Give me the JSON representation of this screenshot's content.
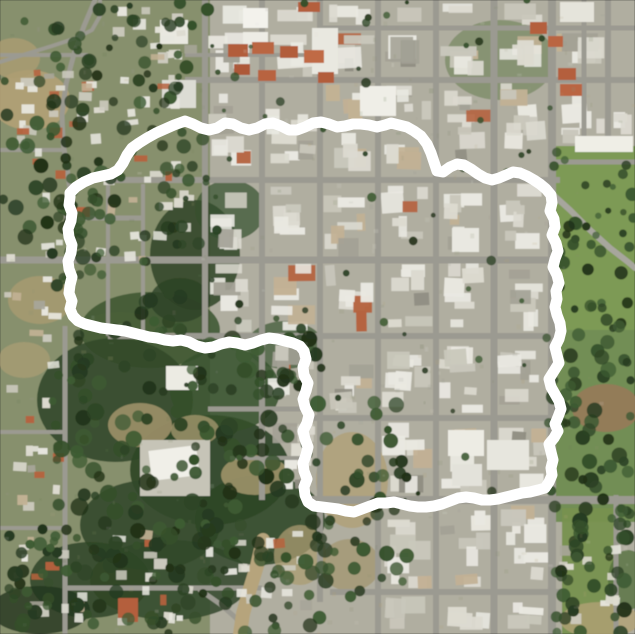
{
  "map": {
    "kind": "satellite-aerial-photo",
    "width": 635,
    "height": 634,
    "seed": 1337,
    "base_color": "#b0aea0",
    "road_color": "#9b9a91",
    "boundary": {
      "stroke": "#ffffff",
      "stroke_width": 11,
      "points": [
        70,
        193,
        76,
        187,
        84,
        182,
        93,
        178,
        102,
        176,
        111,
        174,
        118,
        170,
        123,
        163,
        127,
        155,
        132,
        148,
        139,
        143,
        147,
        138,
        156,
        133,
        165,
        129,
        174,
        125,
        185,
        121,
        193,
        124,
        201,
        128,
        209,
        130,
        217,
        128,
        225,
        123,
        233,
        124,
        241,
        128,
        249,
        130,
        257,
        128,
        265,
        124,
        273,
        123,
        281,
        126,
        289,
        130,
        297,
        130,
        305,
        127,
        313,
        123,
        321,
        122,
        329,
        124,
        337,
        127,
        345,
        126,
        353,
        124,
        361,
        124,
        369,
        125,
        377,
        127,
        385,
        125,
        391,
        123,
        399,
        125,
        407,
        127,
        414,
        131,
        421,
        136,
        427,
        144,
        431,
        153,
        434,
        162,
        437,
        171,
        443,
        172,
        450,
        167,
        457,
        164,
        464,
        165,
        471,
        169,
        478,
        174,
        485,
        178,
        492,
        180,
        499,
        178,
        506,
        175,
        513,
        172,
        520,
        173,
        527,
        176,
        534,
        180,
        540,
        184,
        546,
        189,
        551,
        195,
        552,
        203,
        550,
        211,
        554,
        219,
        555,
        227,
        552,
        235,
        556,
        243,
        558,
        251,
        555,
        259,
        553,
        267,
        557,
        275,
        559,
        283,
        556,
        291,
        557,
        299,
        555,
        307,
        557,
        315,
        560,
        323,
        561,
        331,
        559,
        339,
        555,
        347,
        557,
        355,
        559,
        363,
        554,
        371,
        549,
        379,
        551,
        387,
        555,
        394,
        559,
        401,
        561,
        409,
        558,
        417,
        555,
        424,
        558,
        431,
        554,
        438,
        549,
        444,
        551,
        452,
        553,
        460,
        551,
        468,
        552,
        475,
        549,
        482,
        545,
        488,
        538,
        490,
        530,
        492,
        522,
        493,
        514,
        495,
        506,
        497,
        498,
        499,
        490,
        500,
        482,
        500,
        474,
        498,
        466,
        497,
        458,
        498,
        450,
        501,
        442,
        504,
        434,
        506,
        426,
        507,
        418,
        507,
        410,
        506,
        402,
        504,
        394,
        502,
        386,
        503,
        378,
        503,
        370,
        506,
        362,
        509,
        354,
        512,
        346,
        511,
        338,
        509,
        330,
        508,
        322,
        507,
        314,
        506,
        308,
        502,
        305,
        495,
        304,
        487,
        307,
        479,
        304,
        471,
        303,
        463,
        306,
        455,
        308,
        447,
        305,
        439,
        303,
        431,
        307,
        423,
        309,
        415,
        305,
        407,
        303,
        399,
        306,
        391,
        308,
        383,
        304,
        375,
        303,
        367,
        306,
        359,
        304,
        351,
        300,
        346,
        293,
        343,
        285,
        341,
        277,
        339,
        269,
        338,
        261,
        340,
        253,
        343,
        245,
        345,
        237,
        343,
        229,
        342,
        221,
        344,
        213,
        347,
        205,
        348,
        197,
        346,
        189,
        342,
        181,
        340,
        173,
        341,
        165,
        340,
        157,
        338,
        149,
        337,
        141,
        335,
        133,
        333,
        125,
        331,
        117,
        330,
        109,
        329,
        101,
        328,
        93,
        326,
        85,
        324,
        78,
        321,
        73,
        316,
        70,
        309,
        72,
        301,
        69,
        293,
        70,
        285,
        72,
        277,
        69,
        269,
        68,
        261,
        71,
        253,
        72,
        245,
        69,
        237,
        68,
        229,
        71,
        221,
        72,
        213,
        69,
        205,
        70,
        197
      ]
    },
    "terrain_patches": [
      [
        "r",
        0,
        0,
        210,
        634,
        "#87906d",
        1
      ],
      [
        "e",
        30,
        100,
        40,
        30,
        "#b2a176",
        0.9
      ],
      [
        "e",
        14,
        58,
        26,
        20,
        "#ab9c72",
        0.8
      ],
      [
        "e",
        40,
        300,
        32,
        24,
        "#ab9c72",
        0.75
      ],
      [
        "e",
        24,
        360,
        26,
        18,
        "#b2a176",
        0.6
      ],
      [
        "e",
        120,
        330,
        40,
        18,
        "#a3946c",
        0.5
      ],
      [
        "e",
        150,
        330,
        70,
        38,
        "#3b5530",
        0.85
      ],
      [
        "e",
        195,
        255,
        45,
        55,
        "#2f4527",
        0.85
      ],
      [
        "e",
        230,
        210,
        35,
        30,
        "#35502c",
        0.7
      ],
      [
        "e",
        115,
        400,
        78,
        62,
        "#32492a",
        0.9
      ],
      [
        "e",
        210,
        470,
        80,
        55,
        "#2e4527",
        0.92
      ],
      [
        "e",
        150,
        525,
        70,
        45,
        "#32492a",
        0.9
      ],
      [
        "e",
        260,
        520,
        65,
        45,
        "#2e4527",
        0.88
      ],
      [
        "e",
        225,
        390,
        55,
        42,
        "#35502c",
        0.85
      ],
      [
        "e",
        180,
        300,
        30,
        22,
        "#2c4126",
        0.8
      ],
      [
        "e",
        285,
        345,
        38,
        24,
        "#3b5530",
        0.7
      ],
      [
        "e",
        170,
        580,
        80,
        40,
        "#31482a",
        0.85
      ],
      [
        "e",
        90,
        580,
        60,
        38,
        "#2e4527",
        0.85
      ],
      [
        "e",
        40,
        610,
        50,
        24,
        "#24351f",
        0.8
      ],
      [
        "e",
        140,
        425,
        32,
        22,
        "#a3946c",
        0.85
      ],
      [
        "e",
        255,
        475,
        34,
        20,
        "#ab9c72",
        0.8
      ],
      [
        "e",
        195,
        430,
        24,
        15,
        "#b2a176",
        0.7
      ],
      [
        "e",
        300,
        555,
        26,
        30,
        "#ab9c72",
        0.75
      ],
      [
        "e",
        352,
        480,
        36,
        48,
        "#b0a077",
        0.8
      ],
      [
        "e",
        350,
        565,
        30,
        26,
        "#a3946c",
        0.7
      ],
      [
        "r",
        556,
        146,
        79,
        184,
        "#7d9a55",
        1
      ],
      [
        "r",
        548,
        330,
        87,
        192,
        "#6f8c50",
        0.95
      ],
      [
        "e",
        606,
        408,
        34,
        24,
        "#97795a",
        0.9
      ],
      [
        "r",
        562,
        508,
        52,
        126,
        "#77914f",
        0.95
      ],
      [
        "e",
        600,
        620,
        40,
        18,
        "#b2a176",
        0.8
      ],
      [
        "e",
        628,
        580,
        20,
        30,
        "#55703f",
        0.8
      ],
      [
        "e",
        500,
        60,
        55,
        40,
        "#5d7746",
        0.5
      ]
    ],
    "grid": {
      "xs": [
        205,
        262,
        320,
        378,
        436,
        494,
        552,
        608,
        635
      ],
      "ys": [
        0,
        28,
        80,
        180,
        260,
        336,
        418,
        500,
        592,
        634
      ]
    },
    "roads": {
      "v": [
        [
          205,
          0,
          350,
          6
        ],
        [
          262,
          0,
          500,
          6
        ],
        [
          320,
          0,
          602,
          6
        ],
        [
          378,
          0,
          634,
          6
        ],
        [
          436,
          0,
          634,
          6
        ],
        [
          494,
          0,
          634,
          7
        ],
        [
          552,
          0,
          634,
          8
        ],
        [
          608,
          0,
          152,
          6
        ],
        [
          584,
          0,
          150,
          5
        ],
        [
          616,
          495,
          634,
          5
        ],
        [
          108,
          180,
          336,
          4
        ],
        [
          143,
          184,
          336,
          4
        ],
        [
          65,
          326,
          634,
          5
        ]
      ],
      "h": [
        [
          28,
          320,
          635,
          5
        ],
        [
          55,
          185,
          322,
          4
        ],
        [
          55,
          0,
          88,
          4
        ],
        [
          80,
          185,
          635,
          6
        ],
        [
          150,
          0,
          64,
          4
        ],
        [
          162,
          548,
          635,
          5
        ],
        [
          180,
          108,
          560,
          6
        ],
        [
          218,
          64,
          145,
          5
        ],
        [
          260,
          0,
          560,
          7
        ],
        [
          336,
          108,
          560,
          6
        ],
        [
          409,
          208,
          308,
          5
        ],
        [
          418,
          312,
          560,
          6
        ],
        [
          458,
          230,
          308,
          4
        ],
        [
          432,
          0,
          64,
          4
        ],
        [
          500,
          306,
          635,
          8
        ],
        [
          528,
          0,
          64,
          4
        ],
        [
          588,
          64,
          262,
          5
        ],
        [
          592,
          330,
          560,
          6
        ]
      ],
      "paths": [
        {
          "pts": [
            95,
            0,
            84,
            26,
            74,
            54,
            66,
            84,
            62,
            114,
            63,
            142,
            67,
            168,
            70,
            190
          ],
          "w": 5
        },
        {
          "pts": [
            0,
            62,
            26,
            54,
            52,
            46,
            76,
            38,
            92,
            30,
            100,
            16,
            100,
            0
          ],
          "w": 4
        },
        {
          "pts": [
            550,
            192,
            570,
            210,
            590,
            230,
            610,
            248,
            628,
            262,
            635,
            268
          ],
          "w": 6,
          "c": "#a7a69d"
        },
        {
          "pts": [
            200,
            590,
            220,
            604,
            236,
            618,
            246,
            634
          ],
          "w": 5
        },
        {
          "pts": [
            263,
            540,
            257,
            566,
            249,
            592,
            243,
            614,
            240,
            634
          ],
          "w": 14,
          "c": "#b6a47c"
        }
      ]
    },
    "landmarks": [
      [
        140,
        440,
        70,
        56,
        "#c6c4b7",
        0
      ],
      [
        150,
        448,
        48,
        30,
        "#f0efe8",
        -7
      ],
      [
        166,
        366,
        32,
        24,
        "#ecebe3",
        0
      ],
      [
        160,
        20,
        28,
        24,
        "#e9e8e0",
        0
      ],
      [
        162,
        80,
        34,
        28,
        "#dcdcd4",
        0
      ],
      [
        243,
        8,
        25,
        20,
        "#f3f2ec",
        0
      ],
      [
        243,
        32,
        25,
        17,
        "#edece5",
        0
      ],
      [
        312,
        28,
        26,
        46,
        "#e9e8e0",
        0
      ],
      [
        360,
        86,
        36,
        30,
        "#efeee7",
        0
      ],
      [
        560,
        2,
        34,
        20,
        "#e5e4db",
        0
      ],
      [
        575,
        136,
        58,
        16,
        "#efeee6",
        0
      ],
      [
        452,
        228,
        27,
        24,
        "#e9e8e1",
        0
      ],
      [
        448,
        430,
        36,
        26,
        "#edece4",
        0
      ],
      [
        487,
        440,
        42,
        30,
        "#e7e6de",
        0
      ],
      [
        452,
        464,
        30,
        22,
        "#e3e2da",
        0
      ],
      [
        228,
        44,
        20,
        13,
        "#b25d3b",
        0
      ],
      [
        252,
        42,
        22,
        12,
        "#ba6642",
        0
      ],
      [
        280,
        46,
        18,
        12,
        "#b25d3b",
        0
      ],
      [
        304,
        50,
        20,
        13,
        "#c06a45",
        0
      ],
      [
        318,
        72,
        16,
        11,
        "#b25d3b",
        0
      ],
      [
        234,
        64,
        16,
        11,
        "#ad5838",
        0
      ],
      [
        258,
        70,
        18,
        11,
        "#b86340",
        0
      ],
      [
        530,
        22,
        17,
        12,
        "#b45f3d",
        0
      ],
      [
        548,
        36,
        15,
        11,
        "#ba6542",
        0
      ],
      [
        558,
        68,
        18,
        12,
        "#b45f3d",
        0
      ],
      [
        560,
        84,
        22,
        12,
        "#ba6542",
        0
      ],
      [
        298,
        2,
        22,
        10,
        "#b45f3d",
        0
      ],
      [
        118,
        598,
        20,
        24,
        "#b45f3d",
        0
      ]
    ],
    "house_regions": [
      {
        "x": 4,
        "y": 66,
        "w": 196,
        "h": 196,
        "count": 60
      },
      {
        "x": 2,
        "y": 268,
        "w": 62,
        "h": 255,
        "count": 22
      },
      {
        "x": 6,
        "y": 526,
        "w": 310,
        "h": 102,
        "count": 42
      },
      {
        "x": 100,
        "y": 2,
        "w": 100,
        "h": 62,
        "count": 16
      },
      {
        "x": 558,
        "y": 532,
        "w": 70,
        "h": 96,
        "count": 10
      }
    ],
    "tree_regions": [
      {
        "x": 52,
        "y": 326,
        "w": 266,
        "h": 250,
        "count": 150,
        "rmin": 4,
        "rmax": 9
      },
      {
        "x": 56,
        "y": 118,
        "w": 150,
        "h": 212,
        "count": 65,
        "rmin": 4,
        "rmax": 8
      },
      {
        "x": 0,
        "y": 0,
        "w": 96,
        "h": 264,
        "count": 48,
        "rmin": 4,
        "rmax": 8
      },
      {
        "x": 96,
        "y": 0,
        "w": 112,
        "h": 126,
        "count": 30,
        "rmin": 3,
        "rmax": 7
      },
      {
        "x": 0,
        "y": 522,
        "w": 330,
        "h": 112,
        "count": 85,
        "rmin": 4,
        "rmax": 8
      },
      {
        "x": 554,
        "y": 148,
        "w": 81,
        "h": 182,
        "count": 40,
        "rmin": 3,
        "rmax": 7
      },
      {
        "x": 548,
        "y": 330,
        "w": 87,
        "h": 190,
        "count": 50,
        "rmin": 4,
        "rmax": 8
      },
      {
        "x": 556,
        "y": 520,
        "w": 79,
        "h": 114,
        "count": 35,
        "rmin": 4,
        "rmax": 8
      },
      {
        "x": 185,
        "y": 0,
        "w": 370,
        "h": 515,
        "count": 65,
        "rmin": 2,
        "rmax": 5
      },
      {
        "x": 320,
        "y": 400,
        "w": 100,
        "h": 200,
        "count": 40,
        "rmin": 4,
        "rmax": 8
      }
    ],
    "tree_colors": [
      "#2d4426",
      "#35502b",
      "#263a20",
      "#3e5b33",
      "#223218"
    ],
    "noise_colors": [
      "#6b7a57",
      "#8a9070",
      "#b3a277",
      "#9a9890",
      "#e0dfd6"
    ],
    "noise_count": 260
  }
}
